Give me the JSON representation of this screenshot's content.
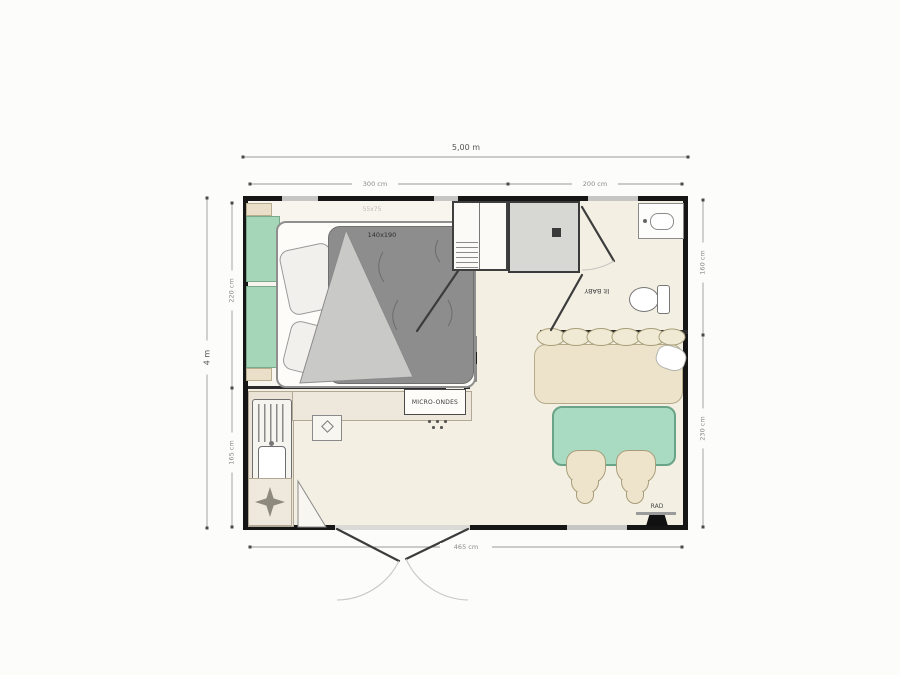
{
  "dimensions": {
    "top_total": "5,00 m",
    "top_left_segment": "300 cm",
    "top_right_segment": "200 cm",
    "left_total": "4 m",
    "left_top_segment": "220 cm",
    "left_bottom_segment": "165 cm",
    "right_top_segment": "160 cm",
    "right_bottom_segment": "230 cm",
    "bottom_inner": "465 cm"
  },
  "labels": {
    "bed_size": "140x190",
    "bed_secondary_size": "55x75",
    "microwave": "MICRO-ONDES",
    "baby_bed": "lit BABY",
    "heater": "RAD"
  },
  "icons": {
    "hob": "four-point-star-icon",
    "heater": "black-trapezoid-heater-icon",
    "shower_drain": "dark-square-drain-icon",
    "sink_drainer": "vertical-stripes-drainer-icon"
  },
  "colors": {
    "wall": "#161616",
    "floor": "#f3efe3",
    "bedroom_floor": "#f8f5ee",
    "headboard_green": "#a5d6b8",
    "table_green": "#a9dbc2",
    "bench_beige": "#ece3ca",
    "shower_gray": "#d7d7d4",
    "duvet_gray": "#8d8d8d",
    "dimension_line": "#9a9a9a"
  }
}
